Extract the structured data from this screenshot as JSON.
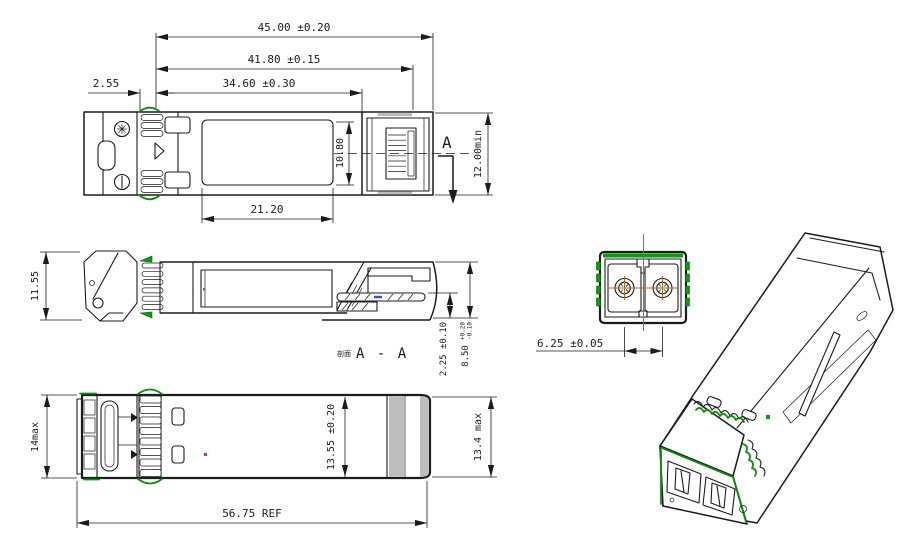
{
  "drawing": {
    "colors": {
      "line": "#1c1c1c",
      "accent_green": "#0a9b0a",
      "centerline_orange": "#b5651d",
      "mark_blue": "#2f55d4",
      "mark_purple": "#a040a0",
      "shade_gray": "#bdbdbd"
    },
    "top_view": {
      "dims": {
        "overall": "45.00 ±0.20",
        "latch": "41.80 ±0.15",
        "body": "34.60 ±0.30",
        "offset": "2.55",
        "label_w": "21.20",
        "label_h": "10.80",
        "port": "12.00min"
      },
      "section_marker": "A"
    },
    "side_view": {
      "dims": {
        "height": "11.55",
        "tab": "2.25 ±0.10",
        "body_h": "8.50",
        "body_h_tol_up": "+0.20",
        "body_h_tol_dn": "-0.10"
      },
      "section_label_cn": "剖面",
      "section_label": "A - A"
    },
    "bottom_view": {
      "dims": {
        "front_h": "14max",
        "mid": "13.55 ±0.20",
        "rear": "13.4 max",
        "overall": "56.75 REF"
      }
    },
    "front_view": {
      "dims": {
        "pitch": "6.25 ±0.05"
      }
    }
  }
}
